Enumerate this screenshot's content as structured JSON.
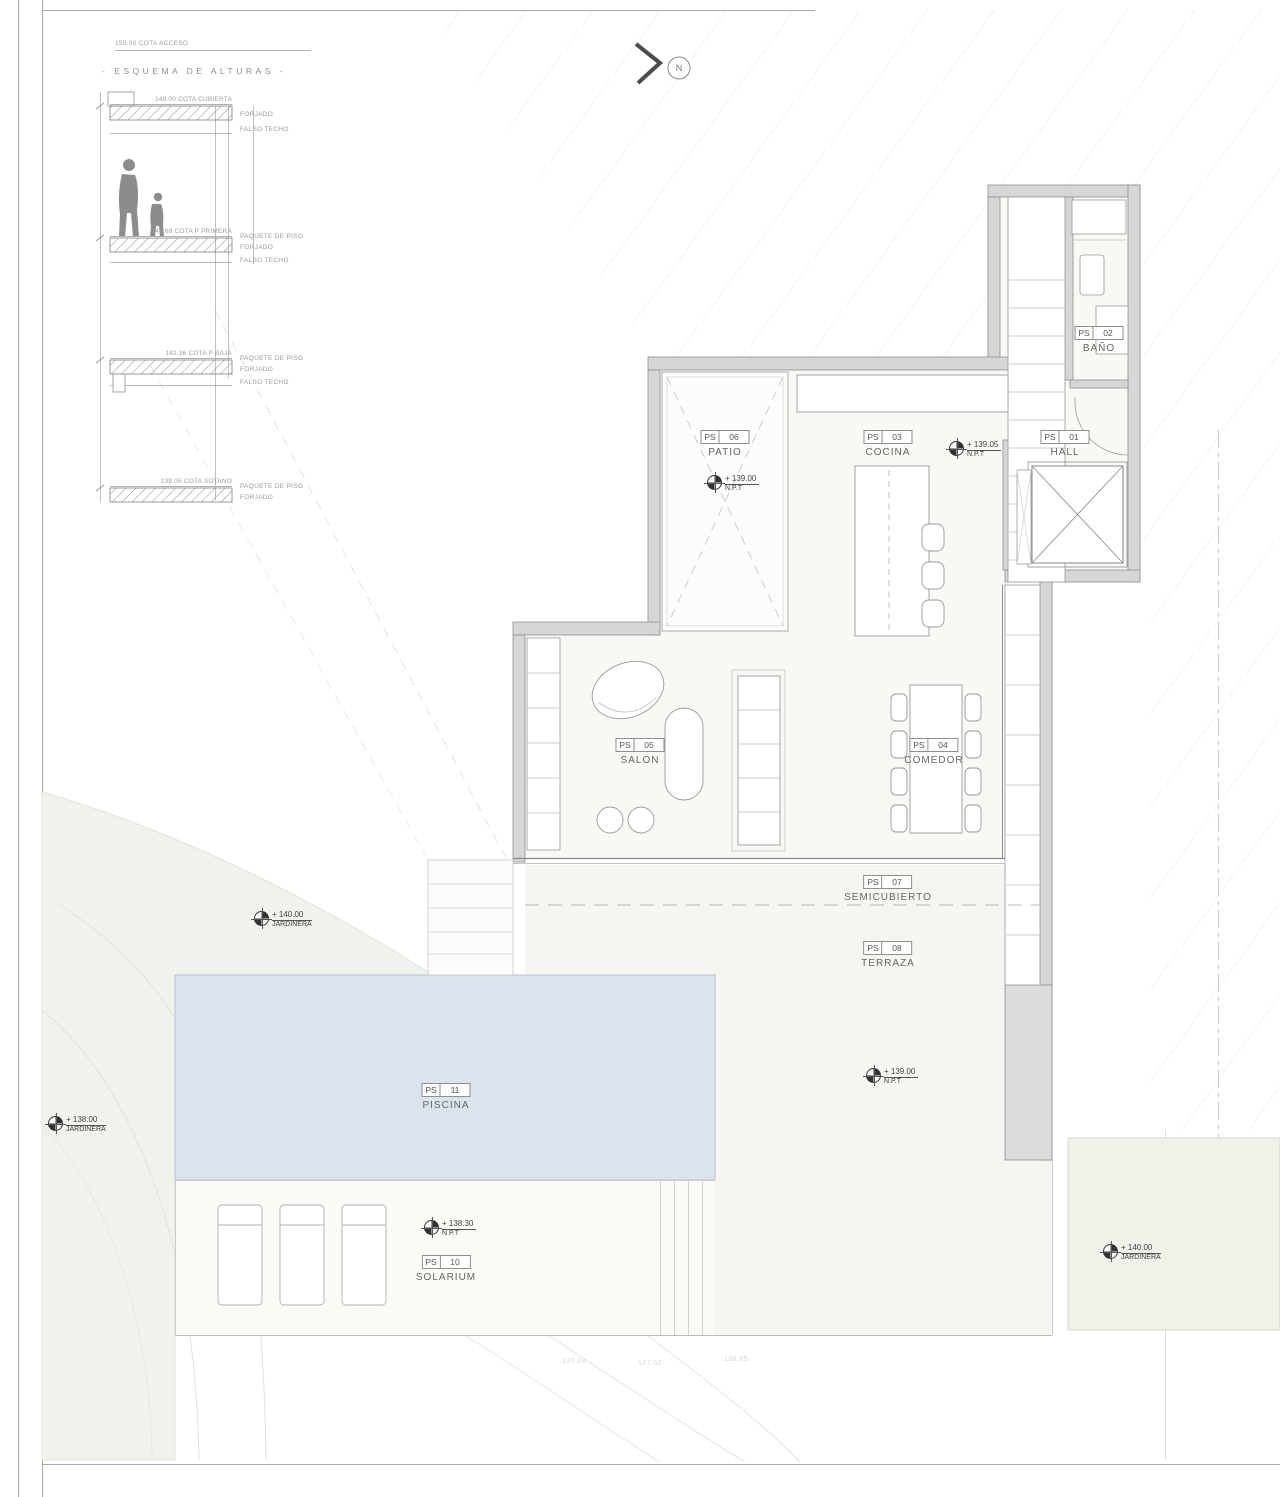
{
  "esquema": {
    "access_note": "155.00 COTA ACCESO",
    "title": "-  ESQUEMA DE ALTURAS  -",
    "levels": [
      {
        "cota": "149.00 COTA CUBIERTA",
        "labels": [
          "FORJADO",
          "FALSO TECHO"
        ]
      },
      {
        "cota": "145.68 COTA P PRIMERA",
        "labels": [
          "PAQUETE DE PISO",
          "FORJADO",
          "FALSO TECHO"
        ]
      },
      {
        "cota": "142.36 COTA P BAJA",
        "labels": [
          "PAQUETE DE PISO",
          "FORJADO",
          "FALSO TECHO"
        ]
      },
      {
        "cota": "139.05 COTA SOTANO",
        "labels": [
          "PAQUETE DE PISO",
          "FORJADO"
        ]
      }
    ]
  },
  "north": {
    "label": "N"
  },
  "rooms": {
    "hall": {
      "code": "PS",
      "num": "01",
      "name": "HALL"
    },
    "bano": {
      "code": "PS",
      "num": "02",
      "name": "BAÑO"
    },
    "cocina": {
      "code": "PS",
      "num": "03",
      "name": "COCINA"
    },
    "comedor": {
      "code": "PS",
      "num": "04",
      "name": "COMEDOR"
    },
    "salon": {
      "code": "PS",
      "num": "05",
      "name": "SALON"
    },
    "patio": {
      "code": "PS",
      "num": "06",
      "name": "PATIO"
    },
    "semicubierto": {
      "code": "PS",
      "num": "07",
      "name": "SEMICUBIERTO"
    },
    "terraza": {
      "code": "PS",
      "num": "08",
      "name": "TERRAZA"
    },
    "solarium": {
      "code": "PS",
      "num": "10",
      "name": "SOLARIUM"
    },
    "piscina": {
      "code": "PS",
      "num": "11",
      "name": "PISCINA"
    }
  },
  "markers": {
    "cocina": {
      "value": "+ 139.05",
      "label": "N.P.T"
    },
    "patio": {
      "value": "+ 139.00",
      "label": "N.P.T"
    },
    "terraza": {
      "value": "+ 139.00",
      "label": "N.P.T"
    },
    "solarium": {
      "value": "+ 138.30",
      "label": "N.P.T"
    },
    "jardinera_left": {
      "value": "+ 140.00",
      "label": "JARDINERA"
    },
    "jardinera_far_left": {
      "value": "+ 138.00",
      "label": "JARDINERA"
    },
    "jardinera_right": {
      "value": "+ 140.00",
      "label": "JARDINERA"
    }
  },
  "contours": {
    "c1": "137.24",
    "c2": "137.02",
    "c3": "138.85"
  },
  "palette": {
    "pool_fill": "#dbe3ec",
    "wall_fill": "#d6d6d6",
    "site_green": "#f0f3ec",
    "hatch_line": "#ebebeb",
    "text_gray": "#666666"
  }
}
